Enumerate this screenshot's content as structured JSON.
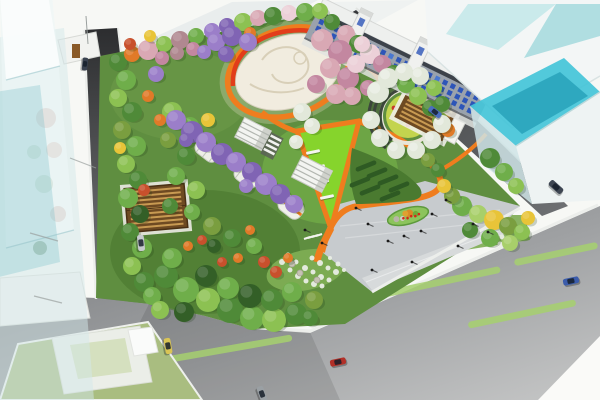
{
  "scene": {
    "description": "Aerial architectural rendering of an urban pocket park with orange pathways, oval paved plaza, wisteria pergola tunnels, cherry trees, circular flower garden with amphitheater steps, gray entry plaza with pedestrians, surrounded by streets with cars and translucent glass buildings",
    "colors": {
      "background": "#f7f8f5",
      "olive_ground": "#b7ba95",
      "road_dark": "#3a3c3e",
      "road_mid": "#8e9093",
      "road_light": "#c2c3c3",
      "curb": "#eceeeb",
      "park_base": "#5f8e40",
      "lawn_bright": "#86d42c",
      "lawn_dark": "#4a7a30",
      "plaza": "#c7cbce",
      "plaza_step": "#d7dadb",
      "path_orange": "#ef7d1e",
      "band_red": "#e23d1a",
      "oval_paving": "#f1ecdf",
      "glass_cyan": "#c2e7e9",
      "glass_teal": "#44c4d8",
      "facade": "#9aa2ac",
      "window_blue": "#2d55b8",
      "pergola_roof": "#6e4a22",
      "pergola_slat": "#c89a52",
      "stripe_green": "#a6d06e",
      "parcel_green": "#a9bd80",
      "flower_bed": "#c3d44e"
    },
    "palette": [
      "#6fae4a",
      "#4f8a38",
      "#8cc152",
      "#335f27",
      "#a8cf6a",
      "#d9a8b4",
      "#c387a0",
      "#9b7ec9",
      "#8064b4",
      "#e07a28",
      "#c8502c",
      "#e8c438",
      "#e2e8da",
      "#b08890",
      "#ecd0d8",
      "#7a9e3f"
    ],
    "trees": [
      [
        118,
        62,
        9,
        1
      ],
      [
        132,
        54,
        8,
        9
      ],
      [
        148,
        50,
        10,
        5
      ],
      [
        164,
        44,
        8,
        2
      ],
      [
        180,
        40,
        9,
        13
      ],
      [
        196,
        36,
        8,
        0
      ],
      [
        212,
        31,
        8,
        7
      ],
      [
        227,
        26,
        8,
        8
      ],
      [
        243,
        22,
        9,
        2
      ],
      [
        258,
        18,
        8,
        5
      ],
      [
        273,
        16,
        9,
        1
      ],
      [
        289,
        13,
        8,
        14
      ],
      [
        305,
        12,
        9,
        0
      ],
      [
        320,
        11,
        8,
        2
      ],
      [
        150,
        36,
        6,
        11
      ],
      [
        130,
        44,
        6,
        10
      ],
      [
        250,
        33,
        6,
        9
      ],
      [
        162,
        58,
        7,
        6
      ],
      [
        177,
        53,
        7,
        13
      ],
      [
        193,
        49,
        7,
        6
      ],
      [
        332,
        22,
        8,
        1
      ],
      [
        346,
        34,
        9,
        5
      ],
      [
        358,
        44,
        9,
        1
      ],
      [
        370,
        54,
        10,
        14
      ],
      [
        382,
        64,
        9,
        6
      ],
      [
        394,
        74,
        9,
        1
      ],
      [
        406,
        84,
        9,
        0
      ],
      [
        418,
        96,
        9,
        2
      ],
      [
        430,
        108,
        8,
        1
      ],
      [
        440,
        120,
        8,
        15
      ],
      [
        448,
        130,
        7,
        9
      ],
      [
        490,
        158,
        10,
        1
      ],
      [
        504,
        172,
        9,
        0
      ],
      [
        516,
        186,
        8,
        2
      ],
      [
        462,
        206,
        10,
        0
      ],
      [
        478,
        214,
        9,
        4
      ],
      [
        494,
        220,
        10,
        11
      ],
      [
        508,
        226,
        9,
        15
      ],
      [
        522,
        232,
        8,
        2
      ],
      [
        470,
        230,
        8,
        1
      ],
      [
        490,
        238,
        9,
        0
      ],
      [
        510,
        243,
        8,
        4
      ],
      [
        528,
        218,
        7,
        11
      ],
      [
        452,
        196,
        8,
        15
      ],
      [
        444,
        186,
        7,
        11
      ],
      [
        126,
        80,
        10,
        0
      ],
      [
        118,
        98,
        9,
        2
      ],
      [
        132,
        112,
        10,
        1
      ],
      [
        122,
        130,
        9,
        15
      ],
      [
        136,
        146,
        10,
        0
      ],
      [
        126,
        164,
        9,
        2
      ],
      [
        138,
        180,
        9,
        1
      ],
      [
        128,
        198,
        10,
        0
      ],
      [
        140,
        214,
        9,
        3
      ],
      [
        130,
        232,
        9,
        1
      ],
      [
        142,
        248,
        10,
        0
      ],
      [
        132,
        266,
        9,
        2
      ],
      [
        144,
        282,
        10,
        1
      ],
      [
        152,
        296,
        9,
        0
      ],
      [
        120,
        148,
        6,
        11
      ],
      [
        148,
        96,
        6,
        9
      ],
      [
        144,
        190,
        6,
        10
      ],
      [
        156,
        74,
        8,
        7
      ],
      [
        166,
        276,
        12,
        1
      ],
      [
        186,
        290,
        13,
        0
      ],
      [
        208,
        300,
        12,
        2
      ],
      [
        230,
        310,
        13,
        1
      ],
      [
        252,
        318,
        12,
        0
      ],
      [
        274,
        320,
        12,
        2
      ],
      [
        296,
        314,
        11,
        1
      ],
      [
        206,
        276,
        11,
        3
      ],
      [
        228,
        288,
        11,
        0
      ],
      [
        250,
        296,
        12,
        3
      ],
      [
        272,
        300,
        11,
        1
      ],
      [
        292,
        292,
        10,
        0
      ],
      [
        184,
        312,
        10,
        3
      ],
      [
        314,
        300,
        9,
        15
      ],
      [
        172,
        258,
        10,
        0
      ],
      [
        160,
        310,
        9,
        2
      ],
      [
        310,
        318,
        8,
        1
      ],
      [
        172,
        112,
        10,
        2
      ],
      [
        190,
        126,
        9,
        0
      ],
      [
        168,
        140,
        8,
        15
      ],
      [
        186,
        156,
        9,
        1
      ],
      [
        176,
        176,
        9,
        0
      ],
      [
        196,
        190,
        9,
        2
      ],
      [
        170,
        206,
        8,
        1
      ],
      [
        192,
        212,
        8,
        0
      ],
      [
        212,
        226,
        9,
        15
      ],
      [
        232,
        238,
        9,
        1
      ],
      [
        254,
        246,
        8,
        0
      ],
      [
        214,
        246,
        7,
        3
      ],
      [
        202,
        240,
        5,
        10
      ],
      [
        188,
        246,
        5,
        9
      ],
      [
        222,
        262,
        5,
        10
      ],
      [
        238,
        258,
        5,
        9
      ],
      [
        250,
        230,
        5,
        9
      ],
      [
        264,
        262,
        6,
        10
      ],
      [
        208,
        120,
        7,
        11
      ],
      [
        160,
        120,
        6,
        9
      ],
      [
        276,
        272,
        6,
        10
      ],
      [
        288,
        258,
        5,
        9
      ],
      [
        176,
        120,
        10,
        7
      ],
      [
        192,
        132,
        11,
        8
      ],
      [
        206,
        142,
        10,
        7
      ],
      [
        222,
        154,
        11,
        8
      ],
      [
        236,
        162,
        10,
        7
      ],
      [
        252,
        172,
        10,
        8
      ],
      [
        266,
        184,
        11,
        7
      ],
      [
        280,
        194,
        10,
        8
      ],
      [
        294,
        204,
        9,
        7
      ],
      [
        186,
        140,
        7,
        8
      ],
      [
        246,
        186,
        7,
        7
      ],
      [
        216,
        42,
        9,
        7
      ],
      [
        232,
        36,
        10,
        8
      ],
      [
        248,
        42,
        9,
        7
      ],
      [
        226,
        54,
        8,
        8
      ],
      [
        204,
        52,
        7,
        7
      ],
      [
        322,
        40,
        11,
        5
      ],
      [
        340,
        52,
        12,
        6
      ],
      [
        330,
        68,
        10,
        5
      ],
      [
        348,
        78,
        11,
        6
      ],
      [
        336,
        94,
        10,
        5
      ],
      [
        356,
        64,
        9,
        14
      ],
      [
        316,
        84,
        9,
        6
      ],
      [
        352,
        96,
        9,
        5
      ],
      [
        362,
        44,
        8,
        14
      ],
      [
        368,
        88,
        8,
        6
      ],
      [
        378,
        92,
        11,
        12
      ],
      [
        388,
        78,
        10,
        12
      ],
      [
        404,
        72,
        9,
        12
      ],
      [
        420,
        76,
        9,
        12
      ],
      [
        434,
        88,
        8,
        2
      ],
      [
        442,
        104,
        8,
        1
      ],
      [
        442,
        124,
        9,
        12
      ],
      [
        432,
        140,
        9,
        12
      ],
      [
        416,
        150,
        9,
        12
      ],
      [
        396,
        150,
        9,
        12
      ],
      [
        380,
        138,
        9,
        12
      ],
      [
        371,
        120,
        9,
        12
      ],
      [
        302,
        112,
        9,
        12
      ],
      [
        312,
        126,
        8,
        12
      ],
      [
        296,
        142,
        7,
        12
      ],
      [
        428,
        160,
        7,
        15
      ],
      [
        438,
        170,
        7,
        1
      ]
    ],
    "people": [
      [
        356,
        208
      ],
      [
        368,
        224
      ],
      [
        388,
        241
      ],
      [
        404,
        236
      ],
      [
        421,
        231
      ],
      [
        432,
        214
      ],
      [
        446,
        200
      ],
      [
        458,
        246
      ],
      [
        473,
        224
      ],
      [
        488,
        232
      ],
      [
        412,
        262
      ],
      [
        372,
        270
      ],
      [
        322,
        243
      ],
      [
        305,
        230
      ]
    ],
    "cars": [
      [
        85,
        64,
        96,
        "#3a4250",
        0.8
      ],
      [
        141,
        243,
        84,
        "#c6cacd",
        1
      ],
      [
        168,
        346,
        80,
        "#d9c455",
        1
      ],
      [
        262,
        394,
        70,
        "#9aa0a4",
        1
      ],
      [
        338,
        362,
        -12,
        "#b23028",
        1
      ],
      [
        571,
        281,
        -12,
        "#3b5cab",
        1
      ],
      [
        556,
        187,
        42,
        "#3e4652",
        1
      ],
      [
        435,
        112,
        38,
        "#4a6cc0",
        0.9
      ]
    ],
    "lane_stripes": [
      [
        422,
        286,
        160,
        -12
      ],
      [
        556,
        254,
        85,
        -12
      ],
      [
        228,
        349,
        130,
        -10
      ],
      [
        522,
        314,
        110,
        -12
      ]
    ],
    "hedges": [
      [
        366,
        166
      ],
      [
        377,
        173
      ],
      [
        388,
        180
      ],
      [
        399,
        187
      ],
      [
        370,
        190
      ],
      [
        360,
        182
      ],
      [
        390,
        196
      ]
    ],
    "benches": [
      [
        313,
        152
      ],
      [
        318,
        167
      ],
      [
        322,
        182
      ],
      [
        327,
        197
      ]
    ],
    "crosswalk_dashes": [
      [
        307,
        238
      ],
      [
        311,
        237
      ],
      [
        315,
        236
      ],
      [
        319,
        235
      ]
    ],
    "flower_palette": [
      "#e07a28",
      "#c83828",
      "#7fb43a",
      "#e8c030",
      "#d86a9a"
    ],
    "garden_flowers": [
      [
        -8,
        -6,
        0
      ],
      [
        -2,
        -10,
        1
      ],
      [
        5,
        -7,
        2
      ],
      [
        10,
        -2,
        0
      ],
      [
        7,
        5,
        3
      ],
      [
        0,
        9,
        1
      ],
      [
        -7,
        6,
        2
      ],
      [
        -12,
        0,
        3
      ],
      [
        2,
        0,
        4
      ],
      [
        -3,
        3,
        0
      ],
      [
        8,
        -12,
        2
      ],
      [
        -14,
        -8,
        1
      ]
    ],
    "island_red_dots": [
      [
        -5,
        1
      ],
      [
        -1,
        2
      ],
      [
        3,
        1
      ],
      [
        7,
        2
      ],
      [
        11,
        1
      ]
    ],
    "white_flowers": [
      [
        282,
        262,
        3
      ],
      [
        290,
        270,
        2.5
      ],
      [
        298,
        276,
        3
      ],
      [
        306,
        281,
        2.5
      ],
      [
        314,
        284,
        3
      ],
      [
        322,
        286,
        2.5
      ],
      [
        296,
        262,
        2.5
      ],
      [
        305,
        268,
        3
      ],
      [
        313,
        272,
        2.5
      ],
      [
        321,
        277,
        3
      ],
      [
        329,
        280,
        2.5
      ],
      [
        312,
        258,
        2.5
      ],
      [
        320,
        263,
        3
      ],
      [
        328,
        268,
        2.5
      ],
      [
        336,
        272,
        3
      ],
      [
        288,
        255,
        2.5
      ],
      [
        330,
        258,
        2
      ],
      [
        338,
        264,
        2.5
      ],
      [
        344,
        270,
        2
      ],
      [
        468,
        226,
        2.5
      ],
      [
        476,
        231,
        3
      ],
      [
        484,
        236,
        2.5
      ],
      [
        492,
        240,
        3
      ],
      [
        500,
        244,
        2.5
      ],
      [
        508,
        247,
        2.5
      ],
      [
        476,
        222,
        2
      ],
      [
        486,
        228,
        2.5
      ],
      [
        494,
        232,
        2
      ],
      [
        502,
        237,
        2.5
      ],
      [
        510,
        240,
        2
      ]
    ],
    "garden_rocks": [
      [
        300,
        273
      ],
      [
        317,
        280
      ],
      [
        292,
        264
      ]
    ],
    "glass_reflection_blobs": [
      [
        46,
        118,
        10,
        "#a84838"
      ],
      [
        54,
        150,
        8,
        "#b85a40"
      ],
      [
        44,
        184,
        9,
        "#4f7a3c"
      ],
      [
        58,
        214,
        8,
        "#a04330"
      ],
      [
        40,
        248,
        7,
        "#48703a"
      ],
      [
        52,
        282,
        8,
        "#9a4838"
      ],
      [
        34,
        152,
        7,
        "#4f7a3c"
      ]
    ],
    "row_building": {
      "window_rows": 3,
      "window_cols": 21
    }
  }
}
